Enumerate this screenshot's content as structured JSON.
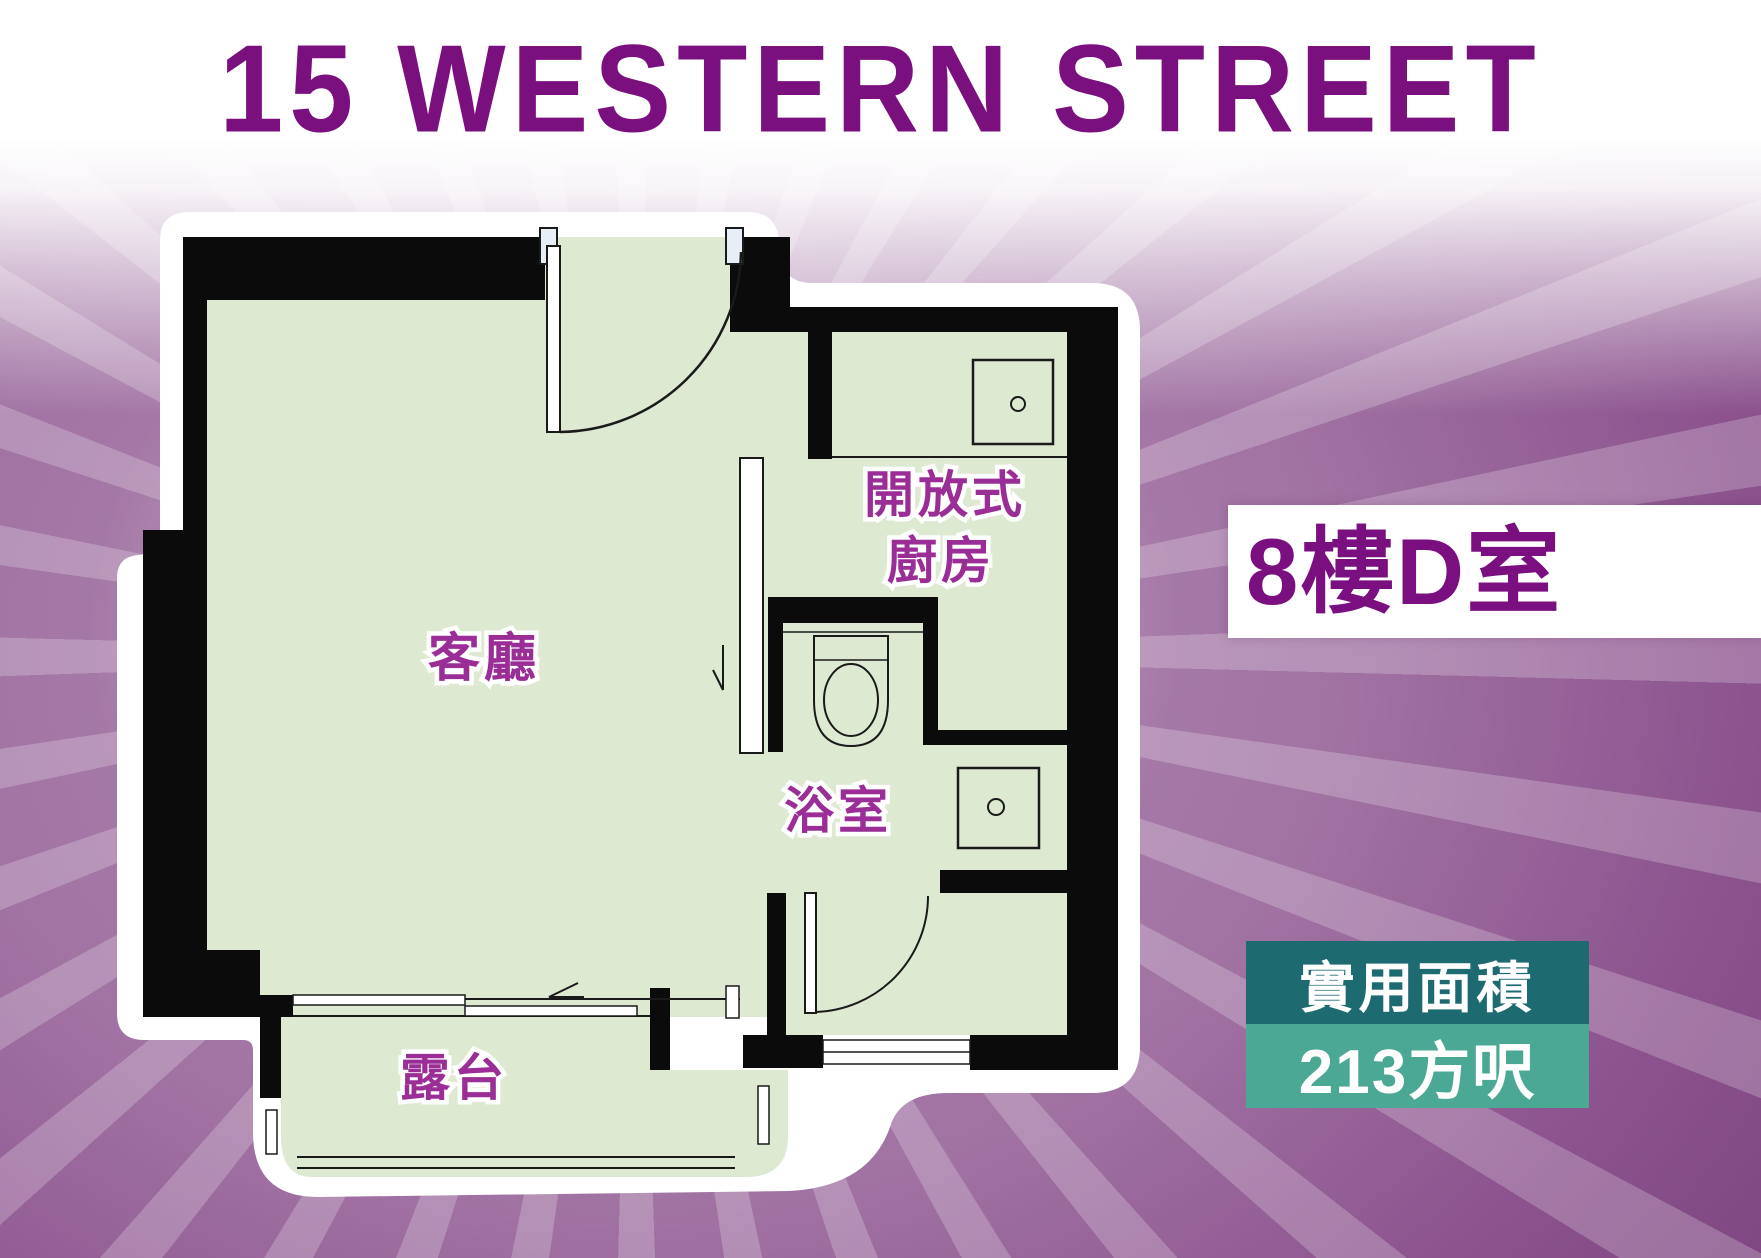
{
  "title": "15 WESTERN STREET",
  "unit": {
    "label": "8樓D室"
  },
  "area": {
    "label": "實用面積",
    "value": "213方呎"
  },
  "floorplan": {
    "rooms": {
      "living": "客廳",
      "kitchen_line1": "開放式",
      "kitchen_line2": "廚房",
      "bathroom": "浴室",
      "balcony": "露台"
    }
  },
  "colors": {
    "title_purple": "#7a0f7e",
    "room_label_purple": "#9a2e96",
    "floor_green": "#dee9d2",
    "wall_black": "#0b0b0b",
    "outline_white": "#ffffff",
    "area_label_teal_dark": "#1d6a70",
    "area_value_teal_light": "#4ba895",
    "background_purple": "#9a6a9c"
  }
}
